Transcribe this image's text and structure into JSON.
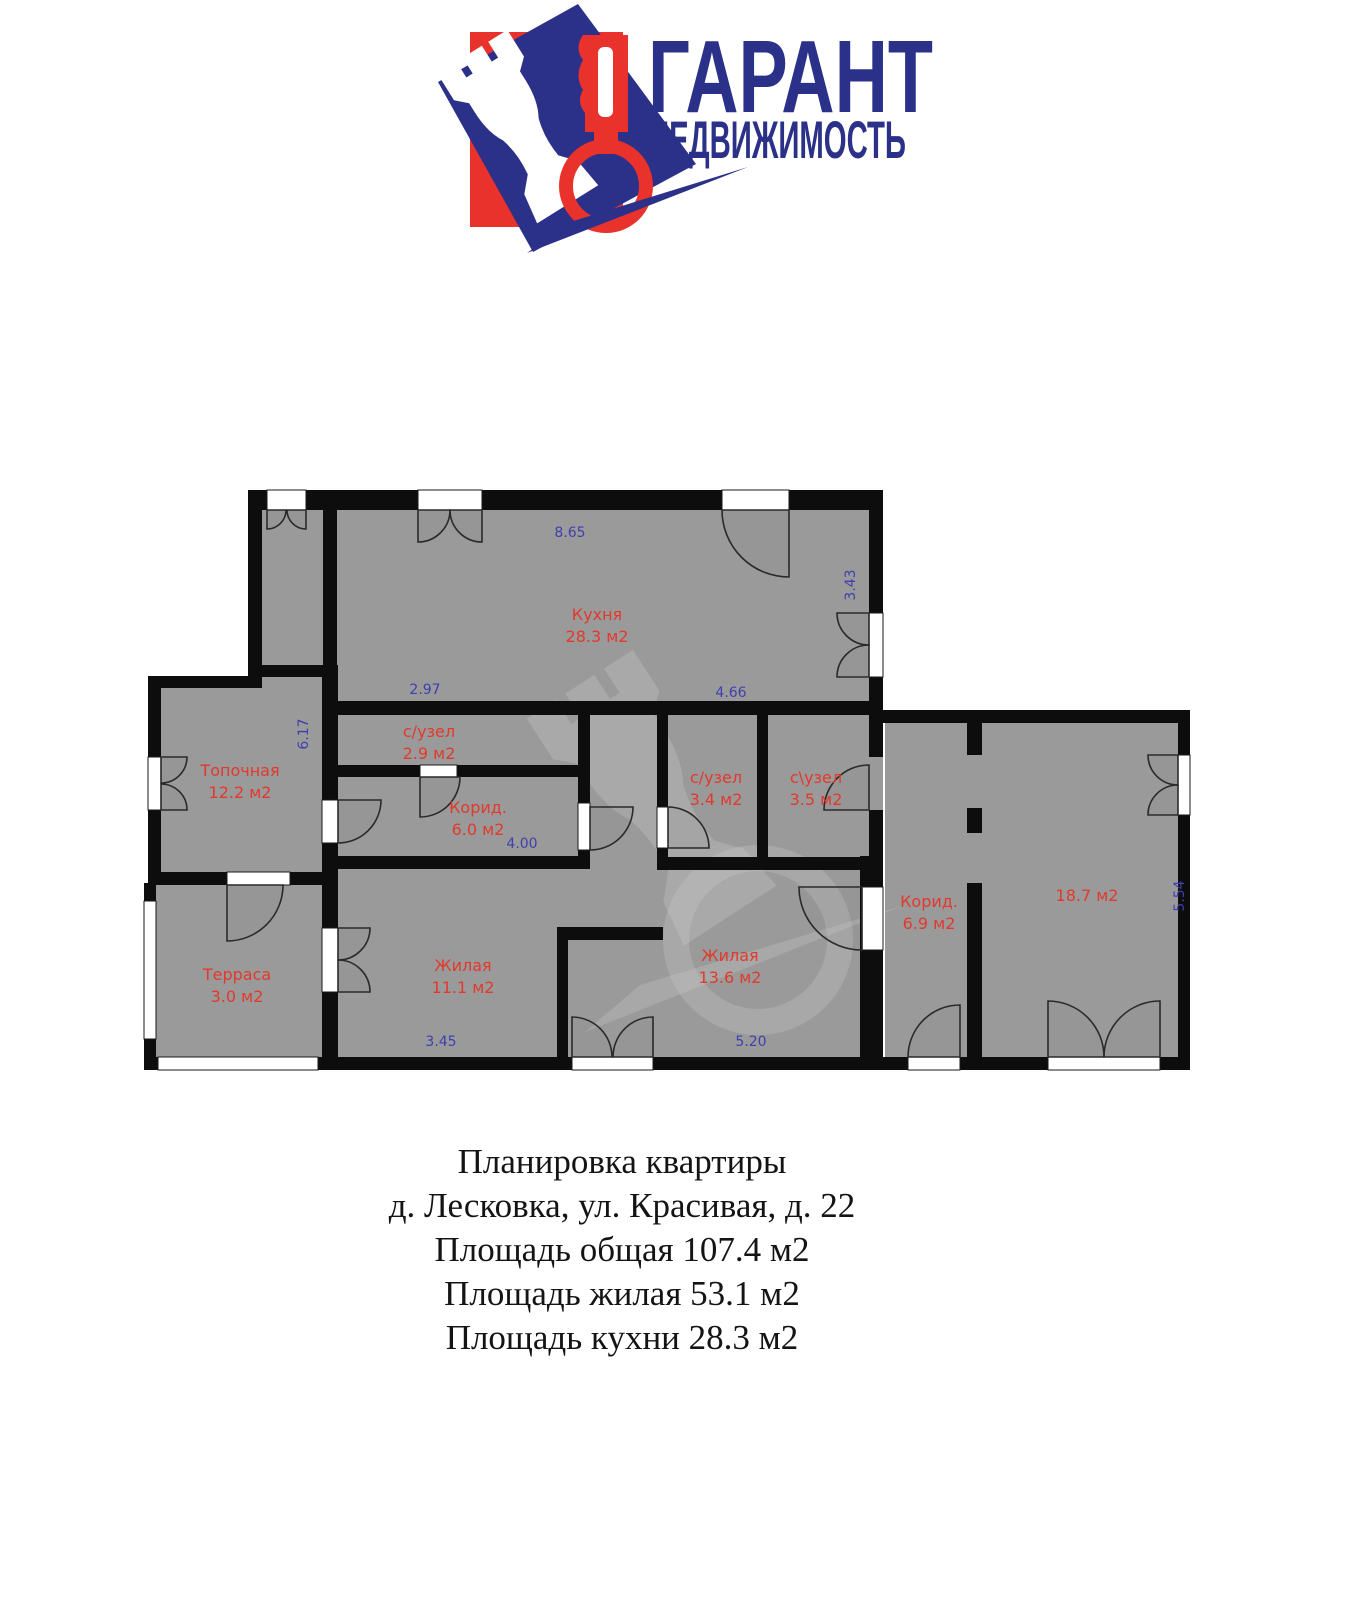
{
  "logo": {
    "line1": "ГАРАНТ",
    "line2": "НЕДВИЖИМОСТЬ"
  },
  "colors": {
    "wall": "#0d0d0d",
    "floor": "#9a9a9a",
    "room_label": "#e2392c",
    "dimension_label": "#3f3fae",
    "logo_navy": "#2b3189",
    "logo_red": "#e9322c"
  },
  "plan": {
    "rooms": [
      {
        "name": "Кухня",
        "area": "28.3 м2"
      },
      {
        "name": "Топочная",
        "area": "12.2 м2"
      },
      {
        "name": "с/узел",
        "area": "2.9 м2"
      },
      {
        "name": "Корид.",
        "area": "6.0 м2"
      },
      {
        "name": "с/узел",
        "area": "3.4 м2"
      },
      {
        "name": "с\\узел",
        "area": "3.5 м2"
      },
      {
        "name": "Терраса",
        "area": "3.0 м2"
      },
      {
        "name": "Жилая",
        "area": "11.1 м2"
      },
      {
        "name": "Жилая",
        "area": "13.6 м2"
      },
      {
        "name": "Корид.",
        "area": "6.9 м2"
      },
      {
        "name": "",
        "area": "18.7 м2"
      }
    ],
    "dims": [
      "8.65",
      "3.43",
      "2.97",
      "4.66",
      "6.17",
      "4.00",
      "3.45",
      "5.20",
      "5.54"
    ]
  },
  "footer": {
    "lines": [
      "Планировка квартиры",
      "д. Лесковка, ул. Красивая, д. 22",
      "Площадь общая 107.4 м2",
      "Площадь жилая 53.1 м2",
      "Площадь кухни 28.3 м2"
    ]
  }
}
